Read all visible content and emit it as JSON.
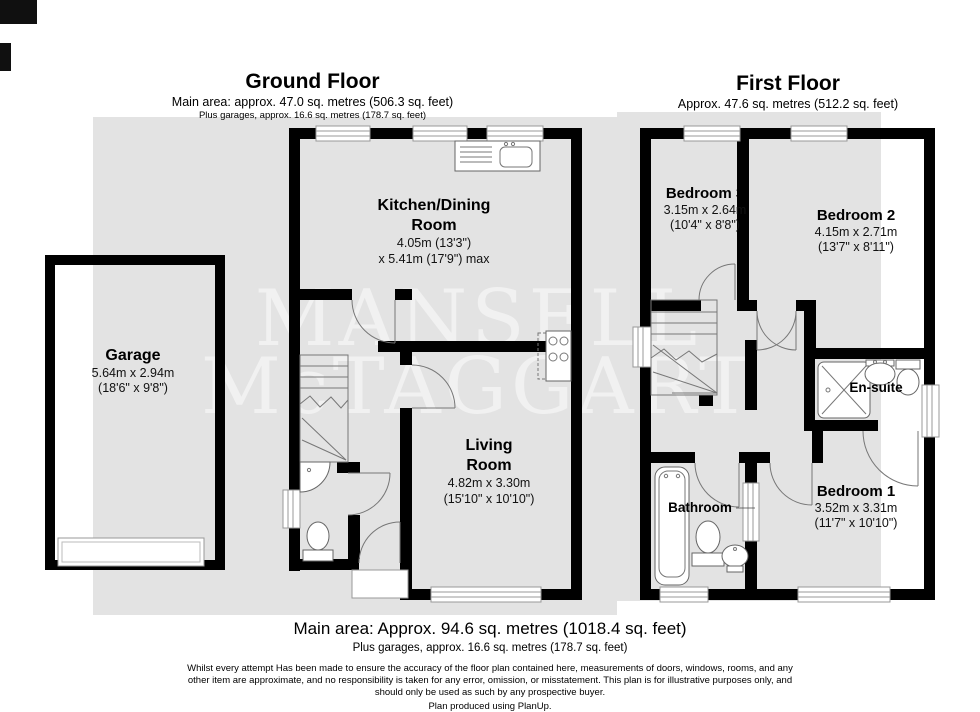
{
  "colors": {
    "page_bg": "#ffffff",
    "plan_bg": "#e3e3e3",
    "wall": "#000000",
    "watermark": "#ffffff"
  },
  "watermark": {
    "line1": "MANSELL",
    "line2": "McTAGGART"
  },
  "ground_floor": {
    "title": "Ground Floor",
    "subtitle": "Main area: approx. 47.0 sq. metres (506.3 sq. feet)",
    "subtitle2": "Plus garages, approx. 16.6 sq. metres (178.7 sq. feet)",
    "rooms": {
      "kitchen": {
        "name_line1": "Kitchen/Dining",
        "name_line2": "Room",
        "dim1": "4.05m (13'3\")",
        "dim2": "x 5.41m (17'9\") max"
      },
      "garage": {
        "name": "Garage",
        "dim1": "5.64m x 2.94m",
        "dim2": "(18'6\" x 9'8\")"
      },
      "living": {
        "name_line1": "Living",
        "name_line2": "Room",
        "dim1": "4.82m x 3.30m",
        "dim2": "(15'10\" x 10'10\")"
      }
    }
  },
  "first_floor": {
    "title": "First Floor",
    "subtitle": "Approx. 47.6 sq. metres (512.2 sq. feet)",
    "rooms": {
      "bedroom3": {
        "name": "Bedroom 3",
        "dim1": "3.15m x 2.64m",
        "dim2": "(10'4\" x 8'8\")"
      },
      "bedroom2": {
        "name": "Bedroom 2",
        "dim1": "4.15m x 2.71m",
        "dim2": "(13'7\" x 8'11\")"
      },
      "bedroom1": {
        "name": "Bedroom 1",
        "dim1": "3.52m x 3.31m",
        "dim2": "(11'7\" x 10'10\")"
      },
      "ensuite": {
        "name": "En-suite"
      },
      "bathroom": {
        "name": "Bathroom"
      }
    }
  },
  "footer": {
    "main_area": "Main area: Approx. 94.6 sq. metres (1018.4 sq. feet)",
    "plus_garages": "Plus garages, approx. 16.6 sq. metres (178.7 sq. feet)",
    "disclaimer_line1": "Whilst every attempt Has been made to ensure the accuracy of the floor plan contained here, measurements of doors, windows, rooms, and any",
    "disclaimer_line2": "other item are approximate, and no responsibility is taken for any error, omission, or misstatement. This plan is for illustrative purposes only, and",
    "disclaimer_line3": "should only be used as such by any prospective buyer.",
    "credit": "Plan produced using PlanUp."
  }
}
